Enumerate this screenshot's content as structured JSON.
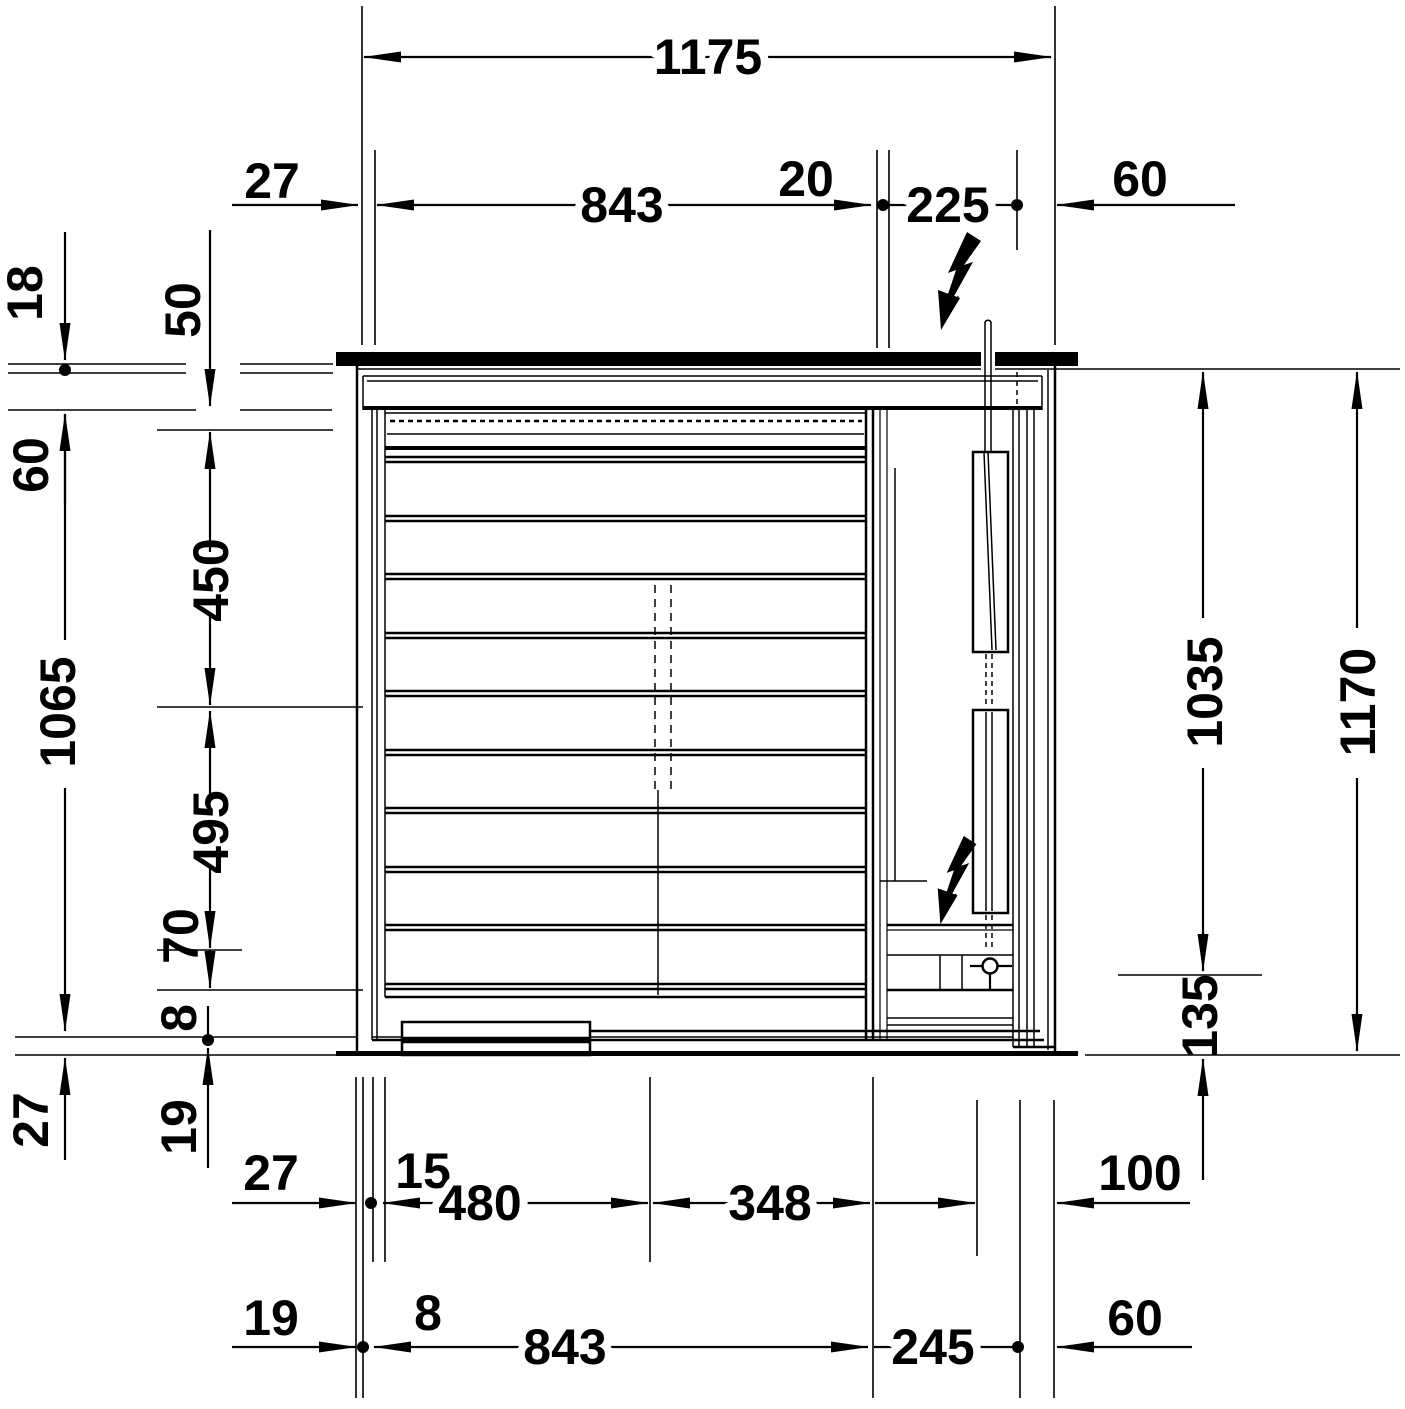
{
  "drawing": {
    "title": "vanity-unit-front-elevation-dimension-drawing",
    "ink_color": "#000000",
    "background_color": "#ffffff",
    "dims": {
      "w_total": "1175",
      "w_offset_l": "27",
      "w_basin": "843",
      "w_gap": "20",
      "w_right": "225",
      "w_offset_r": "60",
      "h_top": "18",
      "h_apron": "50",
      "h_off60": "60",
      "h_450": "450",
      "h_body": "1065",
      "h_495": "495",
      "h_70": "70",
      "h_8": "8",
      "h_27": "27",
      "h_19": "19",
      "h_console": "1035",
      "h_total": "1170",
      "h_plinth": "135",
      "b1_27": "27",
      "b1_15": "15",
      "b1_480": "480",
      "b1_348": "348",
      "b1_100": "100",
      "b2_19": "19",
      "b2_8": "8",
      "b2_843": "843",
      "b2_245": "245",
      "b2_60": "60"
    },
    "icons": {
      "power_top": "lightning-bolt",
      "power_inside": "lightning-bolt",
      "outlet": "power-outlet"
    }
  }
}
